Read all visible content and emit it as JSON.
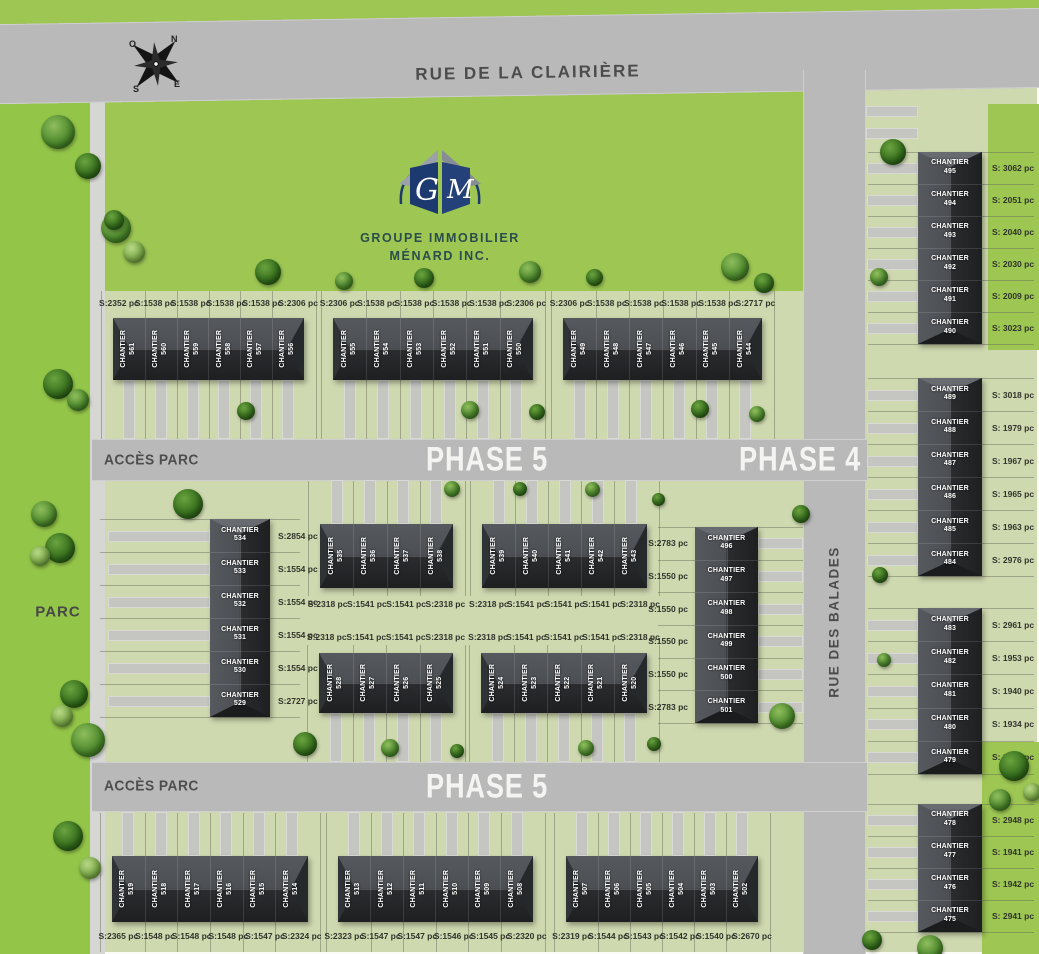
{
  "meta": {
    "title": "Plan de lotissement - Phases 4 et 5"
  },
  "colors": {
    "park_green": "#93c548",
    "lawn_green": "#cfd9b0",
    "bright_green": "#9dc653",
    "road_gray": "#b9b9b9",
    "building_dark": "#232527",
    "logo_navy": "#1c3a70",
    "logo_text_teal": "#2b4d4c",
    "label_gray": "#4c4c4c",
    "area_text": "#30332b",
    "phase_text": "#f4f4f2"
  },
  "compass": {
    "n": "N",
    "e": "E",
    "s": "S",
    "o": "O"
  },
  "streets": {
    "clairiere": "RUE DE LA CLAIRIÈRE",
    "balades": "RUE DES BALADES"
  },
  "labels": {
    "parc": "PARC",
    "acces_parc_top": "ACCÈS PARC",
    "acces_parc_bottom": "ACCÈS PARC",
    "phase5_top": "PHASE 5",
    "phase4": "PHASE 4",
    "phase5_bottom": "PHASE 5"
  },
  "logo": {
    "letter_left": "G",
    "letter_right": "M",
    "name_line1": "GROUPE IMMOBILIER",
    "name_line2": "MÉNARD INC."
  },
  "lot_prefix": "CHANTIER",
  "buildings": [
    {
      "id": "north-1",
      "phase": "5",
      "units": [
        {
          "lot": "561",
          "area": "S:2352 pc"
        },
        {
          "lot": "560",
          "area": "S:1538 pc"
        },
        {
          "lot": "559",
          "area": "S:1538 pc"
        },
        {
          "lot": "558",
          "area": "S:1538 pc"
        },
        {
          "lot": "557",
          "area": "S:1538 pc"
        },
        {
          "lot": "556",
          "area": "S:2306 pc"
        }
      ]
    },
    {
      "id": "north-2",
      "phase": "5",
      "units": [
        {
          "lot": "555",
          "area": "S:2306 pc"
        },
        {
          "lot": "554",
          "area": "S:1538 pc"
        },
        {
          "lot": "553",
          "area": "S:1538 pc"
        },
        {
          "lot": "552",
          "area": "S:1538 pc"
        },
        {
          "lot": "551",
          "area": "S:1538 pc"
        },
        {
          "lot": "550",
          "area": "S:2306 pc"
        }
      ]
    },
    {
      "id": "north-3",
      "phase": "5",
      "units": [
        {
          "lot": "549",
          "area": "S:2306 pc"
        },
        {
          "lot": "548",
          "area": "S:1538 pc"
        },
        {
          "lot": "547",
          "area": "S:1538 pc"
        },
        {
          "lot": "546",
          "area": "S:1538 pc"
        },
        {
          "lot": "545",
          "area": "S:1538 pc"
        },
        {
          "lot": "544",
          "area": "S:2717 pc"
        }
      ]
    },
    {
      "id": "mid-west",
      "phase": "5",
      "units": [
        {
          "lot": "534",
          "area": "S:2854 pc"
        },
        {
          "lot": "533",
          "area": "S:1554 pc"
        },
        {
          "lot": "532",
          "area": "S:1554 pc"
        },
        {
          "lot": "531",
          "area": "S:1554 pc"
        },
        {
          "lot": "530",
          "area": "S:1554 pc"
        },
        {
          "lot": "529",
          "area": "S:2727 pc"
        }
      ]
    },
    {
      "id": "mid-upper-left",
      "phase": "5",
      "units": [
        {
          "lot": "535",
          "area": "S:2318 pc"
        },
        {
          "lot": "536",
          "area": "S:1541 pc"
        },
        {
          "lot": "537",
          "area": "S:1541 pc"
        },
        {
          "lot": "538",
          "area": "S:2318 pc"
        }
      ]
    },
    {
      "id": "mid-upper-right",
      "phase": "5",
      "units": [
        {
          "lot": "539",
          "area": "S:2318 pc"
        },
        {
          "lot": "540",
          "area": "S:1541 pc"
        },
        {
          "lot": "541",
          "area": "S:1541 pc"
        },
        {
          "lot": "542",
          "area": "S:1541 pc"
        },
        {
          "lot": "543",
          "area": "S:2318 pc"
        }
      ]
    },
    {
      "id": "mid-lower-left",
      "phase": "5",
      "units": [
        {
          "lot": "528",
          "area": "S:2318 pc"
        },
        {
          "lot": "527",
          "area": "S:1541 pc"
        },
        {
          "lot": "526",
          "area": "S:1541 pc"
        },
        {
          "lot": "525",
          "area": "S:2318 pc"
        }
      ]
    },
    {
      "id": "mid-lower-right",
      "phase": "5",
      "units": [
        {
          "lot": "524",
          "area": "S:2318 pc"
        },
        {
          "lot": "523",
          "area": "S:1541 pc"
        },
        {
          "lot": "522",
          "area": "S:1541 pc"
        },
        {
          "lot": "521",
          "area": "S:1541 pc"
        },
        {
          "lot": "520",
          "area": "S:2318 pc"
        }
      ]
    },
    {
      "id": "mid-east",
      "phase": "4",
      "units": [
        {
          "lot": "496",
          "area": "S:2783 pc"
        },
        {
          "lot": "497",
          "area": "S:1550 pc"
        },
        {
          "lot": "498",
          "area": "S:1550 pc"
        },
        {
          "lot": "499",
          "area": "S:1550 pc"
        },
        {
          "lot": "500",
          "area": "S:1550 pc"
        },
        {
          "lot": "501",
          "area": "S:2783 pc"
        }
      ]
    },
    {
      "id": "south-1",
      "phase": "5",
      "units": [
        {
          "lot": "519",
          "area": "S:2365 pc"
        },
        {
          "lot": "518",
          "area": "S:1548 pc"
        },
        {
          "lot": "517",
          "area": "S:1548 pc"
        },
        {
          "lot": "516",
          "area": "S:1548 pc"
        },
        {
          "lot": "515",
          "area": "S:1547 pc"
        },
        {
          "lot": "514",
          "area": "S:2324 pc"
        }
      ]
    },
    {
      "id": "south-2",
      "phase": "5",
      "units": [
        {
          "lot": "513",
          "area": "S:2323 pc"
        },
        {
          "lot": "512",
          "area": "S:1547 pc"
        },
        {
          "lot": "511",
          "area": "S:1547 pc"
        },
        {
          "lot": "510",
          "area": "S:1546 pc"
        },
        {
          "lot": "509",
          "area": "S:1545 pc"
        },
        {
          "lot": "508",
          "area": "S:2320 pc"
        }
      ]
    },
    {
      "id": "south-3",
      "phase": "5",
      "units": [
        {
          "lot": "507",
          "area": "S:2319 pc"
        },
        {
          "lot": "506",
          "area": "S:1544 pc"
        },
        {
          "lot": "505",
          "area": "S:1543 pc"
        },
        {
          "lot": "504",
          "area": "S:1542 pc"
        },
        {
          "lot": "503",
          "area": "S:1540 pc"
        },
        {
          "lot": "502",
          "area": "S:2670 pc"
        }
      ]
    },
    {
      "id": "east-1",
      "phase": "4",
      "units": [
        {
          "lot": "495",
          "area": "S: 3062 pc"
        },
        {
          "lot": "494",
          "area": "S: 2051 pc"
        },
        {
          "lot": "493",
          "area": "S: 2040 pc"
        },
        {
          "lot": "492",
          "area": "S: 2030 pc"
        },
        {
          "lot": "491",
          "area": "S: 2009 pc"
        },
        {
          "lot": "490",
          "area": "S: 3023 pc"
        }
      ]
    },
    {
      "id": "east-2",
      "phase": "4",
      "units": [
        {
          "lot": "489",
          "area": "S: 3018 pc"
        },
        {
          "lot": "488",
          "area": "S: 1979 pc"
        },
        {
          "lot": "487",
          "area": "S: 1967 pc"
        },
        {
          "lot": "486",
          "area": "S: 1965 pc"
        },
        {
          "lot": "485",
          "area": "S: 1963 pc"
        },
        {
          "lot": "484",
          "area": "S: 2976 pc"
        }
      ]
    },
    {
      "id": "east-3",
      "phase": "4",
      "units": [
        {
          "lot": "483",
          "area": "S: 2961 pc"
        },
        {
          "lot": "482",
          "area": "S: 1953 pc"
        },
        {
          "lot": "481",
          "area": "S: 1940 pc"
        },
        {
          "lot": "480",
          "area": "S: 1934 pc"
        },
        {
          "lot": "479",
          "area": "S: 2940 pc"
        }
      ]
    },
    {
      "id": "east-4",
      "phase": "4",
      "units": [
        {
          "lot": "478",
          "area": "S: 2948 pc"
        },
        {
          "lot": "477",
          "area": "S: 1941 pc"
        },
        {
          "lot": "476",
          "area": "S: 1942 pc"
        },
        {
          "lot": "475",
          "area": "S: 2941 pc"
        }
      ]
    }
  ]
}
